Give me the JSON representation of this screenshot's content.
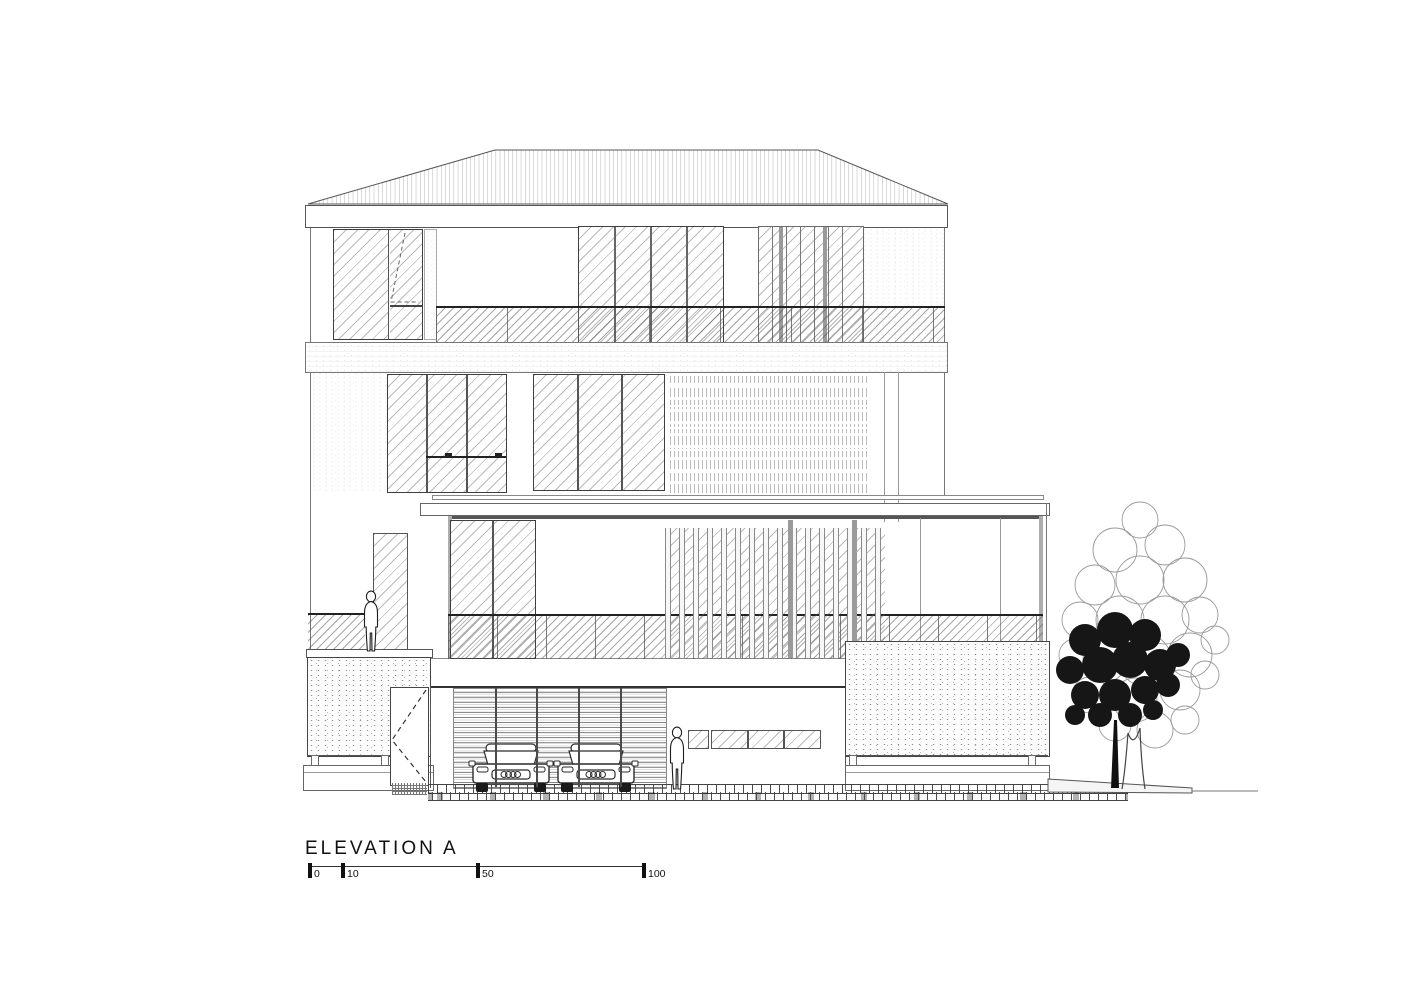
{
  "drawing": {
    "title": "ELEVATION A",
    "scale_bar": {
      "ticks": [
        "0",
        "10",
        "50",
        "100"
      ]
    },
    "colors": {
      "paper": "#ffffff",
      "ink": "#1a1a1a",
      "line": "#555555",
      "hatch": "#8f8f8f",
      "foliage_dark": "#161616"
    }
  }
}
